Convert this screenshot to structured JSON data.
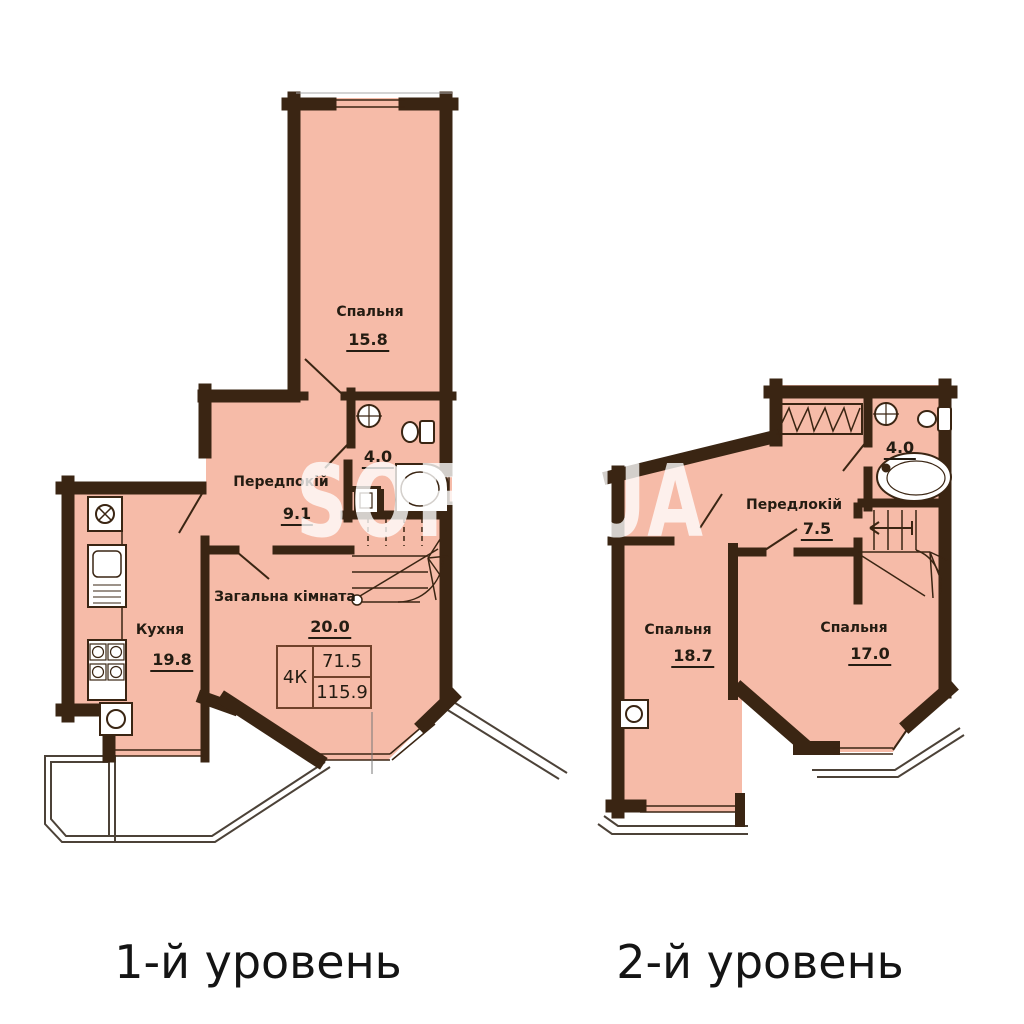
{
  "watermark": "SOFIA UA",
  "colors": {
    "floor": "#f6bba8",
    "wall": "#3a2513",
    "line": "#3a2513",
    "balcony_line": "#4c4238",
    "text": "#241c12"
  },
  "level1": {
    "caption": "1-й уровень",
    "rooms": {
      "bedroom": {
        "name": "Спальня",
        "area": "15.8"
      },
      "hallway": {
        "name": "Передпокій",
        "area": "9.1"
      },
      "bathroom": {
        "area": "4.0"
      },
      "kitchen": {
        "name": "Кухня",
        "area": "19.8"
      },
      "living": {
        "name": "Загальна кімната",
        "area": "20.0"
      }
    },
    "info": {
      "rooms": "4К",
      "living_area": "71.5",
      "total_area": "115.9"
    }
  },
  "level2": {
    "caption": "2-й уровень",
    "rooms": {
      "hallway": {
        "name": "Передлокій",
        "area": "7.5"
      },
      "bathroom": {
        "area": "4.0"
      },
      "bedroom_left": {
        "name": "Спальня",
        "area": "18.7"
      },
      "bedroom_right": {
        "name": "Спальня",
        "area": "17.0"
      }
    }
  }
}
